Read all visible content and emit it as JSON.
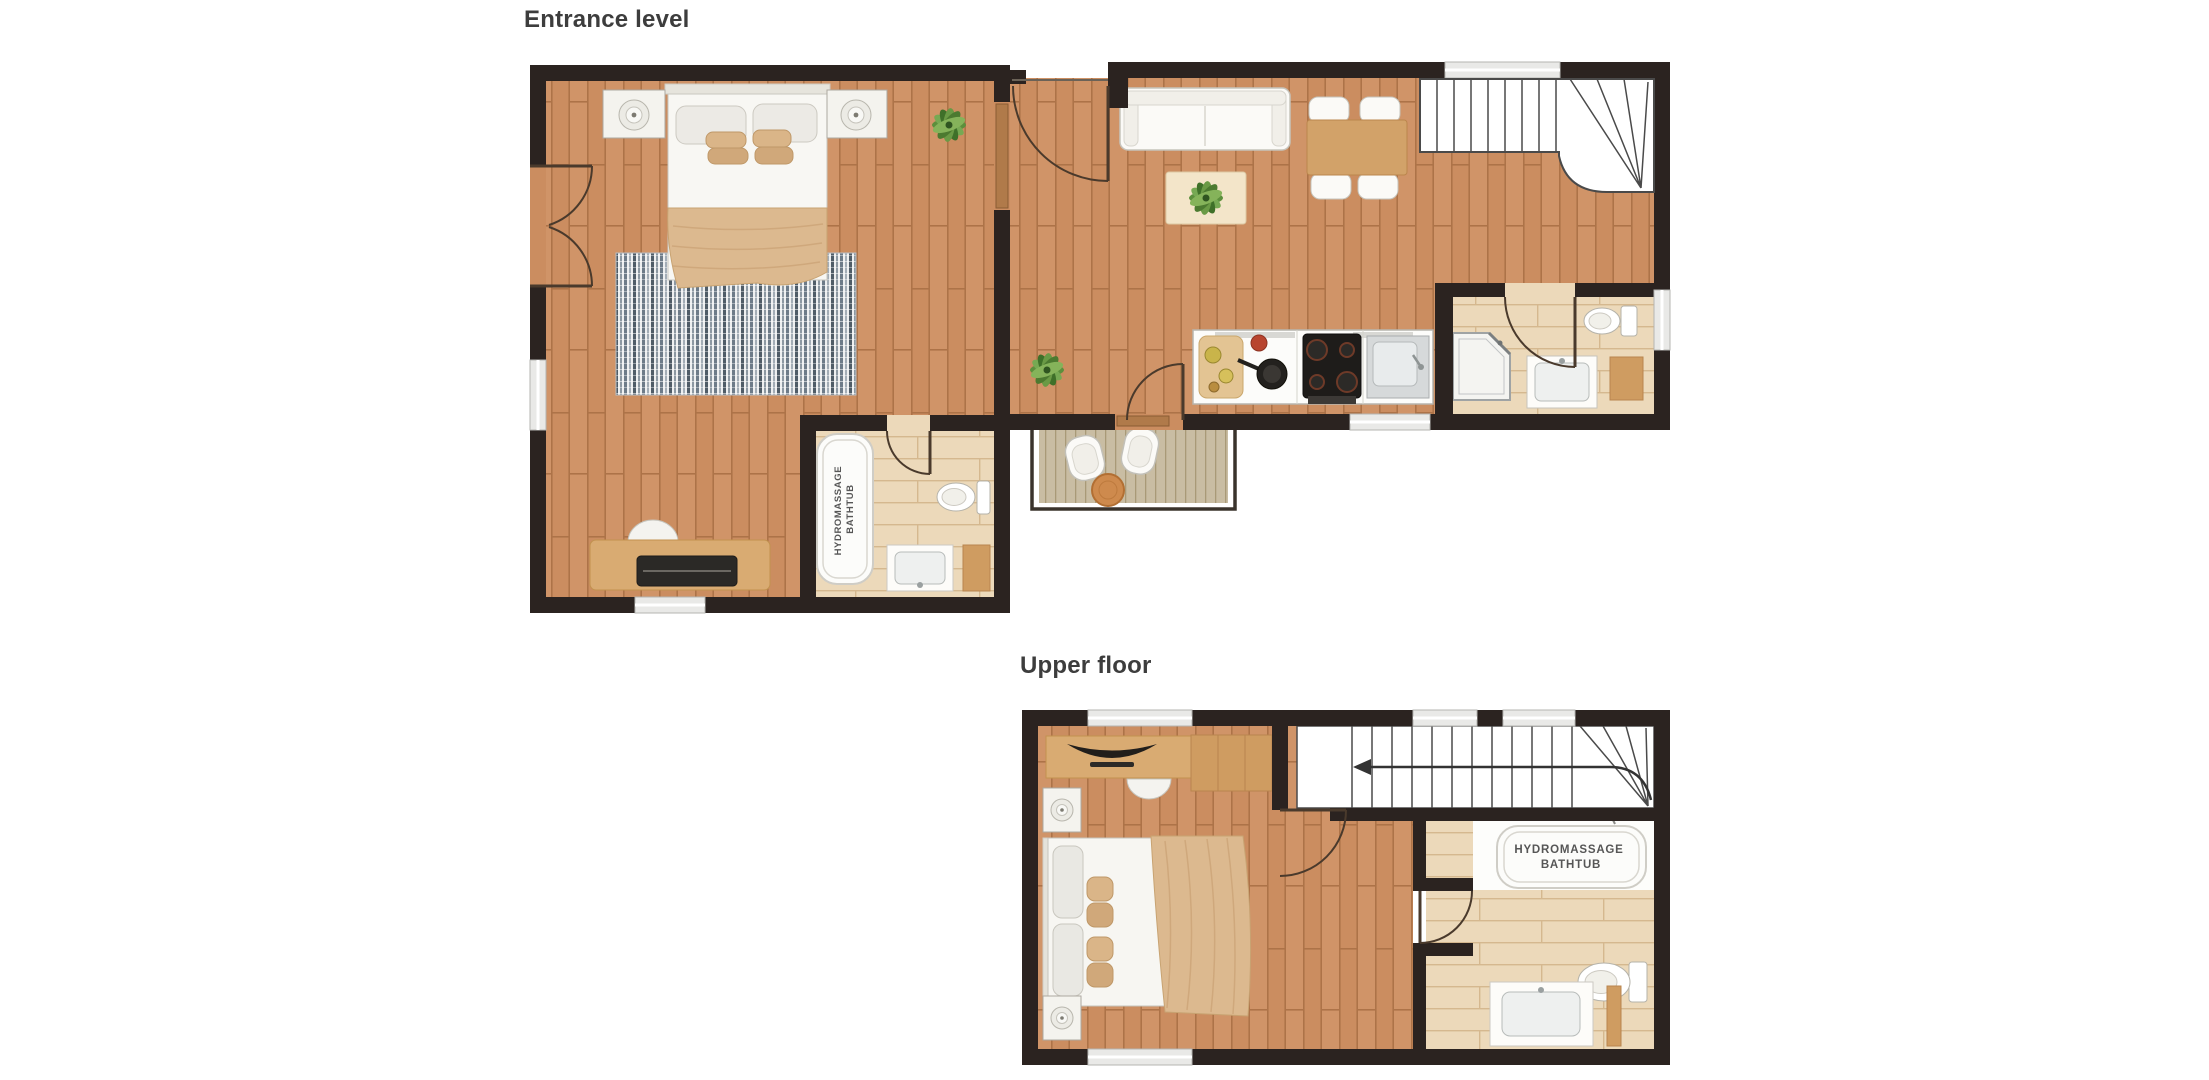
{
  "canvas": {
    "width": 2209,
    "height": 1080,
    "background": "#ffffff"
  },
  "palette": {
    "wall": "#2b2320",
    "wood_floor": "#cb8d60",
    "wood_line": "#ad7348",
    "bath_floor": "#ecd9ba",
    "bath_line": "#d5b88f",
    "deck_floor": "#c9bda3",
    "white_furniture": "#fbfaf7",
    "furniture_stroke": "#c6c4bc",
    "blanket_tan": "#dcb98f",
    "wood_furniture": "#d2a269",
    "rug_stripe": "#6d7b88",
    "plant_green": "#6a9a45",
    "terrace_table": "#ce8a4d",
    "stair_line": "#4a4a4a",
    "title_color": "#3d3d3d",
    "label_color": "#565656"
  },
  "floors": [
    {
      "id": "entrance-level",
      "title": "Entrance level",
      "rooms": [
        "bedroom",
        "hall",
        "living-dining-room",
        "kitchen",
        "en-suite-bathroom",
        "shower-room",
        "balcony"
      ],
      "furniture": [
        "double-bed",
        "nightstands-with-lamps",
        "striped-rug",
        "desk-with-laptop",
        "desk-chair",
        "potted-plants",
        "hydromassage-bathtub",
        "toilets",
        "washbasins",
        "sofa",
        "coffee-table",
        "dining-table-with-four-chairs",
        "staircase",
        "kitchen-counter-stove-sink",
        "corner-shower",
        "balcony-armchairs",
        "balcony-side-table",
        "french-doors"
      ],
      "bathtub_label": {
        "line1": "HYDROMASSAGE",
        "line2": "BATHTUB"
      }
    },
    {
      "id": "upper-floor",
      "title": "Upper floor",
      "rooms": [
        "bedroom",
        "landing",
        "bathroom"
      ],
      "furniture": [
        "double-bed",
        "nightstands-with-lamps",
        "desk-with-tv",
        "desk-chair",
        "staircase-with-direction-arrow",
        "hydromassage-bathtub",
        "toilet",
        "washbasin-counter"
      ],
      "bathtub_label": {
        "line1": "HYDROMASSAGE",
        "line2": "BATHTUB"
      }
    }
  ]
}
